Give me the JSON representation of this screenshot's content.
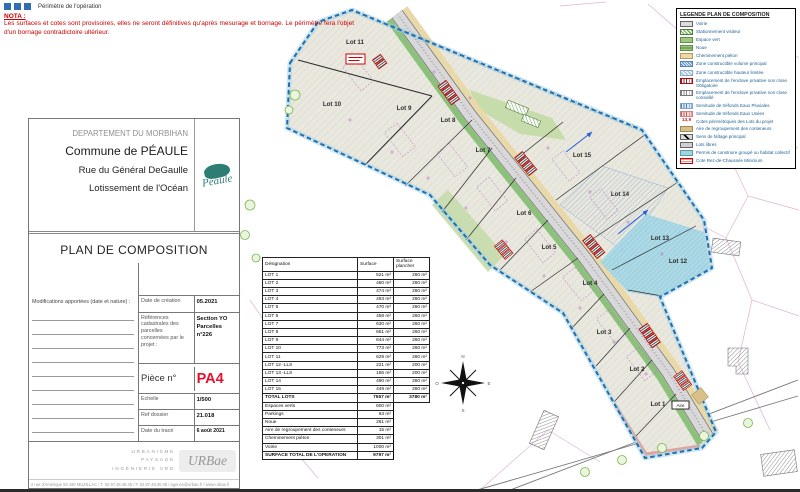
{
  "nota": {
    "perimeter_label": "Périmètre de l'opération",
    "title": "NOTA :",
    "text": "Les surfaces et cotes sont provisoires, elles ne seront définitives qu'après mesurage et bornage. Le périmètre fera l'objet d'un bornage contradictoire ultérieur."
  },
  "title_block": {
    "department": "DEPARTEMENT DU MORBIHAN",
    "commune": "Commune de PÉAULE",
    "street": "Rue du Général DeGaulle",
    "project": "Lotissement de l'Océan",
    "doc_title": "PLAN DE COMPOSITION",
    "logo_text": "Péaule",
    "modifications_label": "Modifications apportées (date et nature) :",
    "date_creation_label": "Date de création",
    "date_creation_value": "05.2021",
    "cadastral_label": "Références cadastrales des parcelles concernées par le projet :",
    "cadastral_value_1": "Section YO",
    "cadastral_value_2": "Parcelles n°226",
    "piece_label": "Pièce n°",
    "piece_value": "PA4",
    "echelle_label": "Echelle",
    "echelle_value": "1/500",
    "ref_label": "Ref dossier",
    "ref_value": "21.018",
    "trace_label": "Date du tracé",
    "trace_value": "6 août 2021"
  },
  "agency": {
    "lines": [
      "URBANISME",
      "PAYSAGE",
      "INGÉNIERIE VRD"
    ],
    "logo": "URBae",
    "address": "2 rue d'Amérique 56 190 MUZILLAC / T. 02.97.45.49.49 / F. 02.97.48.30.35 / agence@urbae.fr / www.urbae.fr"
  },
  "table": {
    "headers": [
      "Désignation",
      "Surface",
      "Surface plancher"
    ],
    "lot_rows": [
      {
        "name": "LOT 1",
        "surface": "521 m²",
        "plancher": "260 m²"
      },
      {
        "name": "LOT 2",
        "surface": "460 m²",
        "plancher": "260 m²"
      },
      {
        "name": "LOT 3",
        "surface": "474 m²",
        "plancher": "260 m²"
      },
      {
        "name": "LOT 4",
        "surface": "493 m²",
        "plancher": "260 m²"
      },
      {
        "name": "LOT 5",
        "surface": "470 m²",
        "plancher": "260 m²"
      },
      {
        "name": "LOT 6",
        "surface": "458 m²",
        "plancher": "260 m²"
      },
      {
        "name": "LOT 7",
        "surface": "630 m²",
        "plancher": "260 m²"
      },
      {
        "name": "LOT 8",
        "surface": "661 m²",
        "plancher": "260 m²"
      },
      {
        "name": "LOT 9",
        "surface": "644 m²",
        "plancher": "260 m²"
      },
      {
        "name": "LOT 10",
        "surface": "773 m²",
        "plancher": "260 m²"
      },
      {
        "name": "LOT 11",
        "surface": "629 m²",
        "plancher": "260 m²"
      },
      {
        "name": "LOT 12 -LLS",
        "surface": "221 m²",
        "plancher": "200 m²"
      },
      {
        "name": "LOT 13 -LLS",
        "surface": "186 m²",
        "plancher": "200 m²"
      },
      {
        "name": "LOT 14",
        "surface": "490 m²",
        "plancher": "260 m²"
      },
      {
        "name": "LOT 15",
        "surface": "449 m²",
        "plancher": "260 m²"
      }
    ],
    "total_row": {
      "name": "TOTAL LOTS",
      "surface": "7557 m²",
      "plancher": "3780 m²"
    },
    "extra_rows": [
      {
        "name": "Espaces verts",
        "surface": "600 m²"
      },
      {
        "name": "Parkings",
        "surface": "63 m²"
      },
      {
        "name": "Noue",
        "surface": "261 m²"
      },
      {
        "name": "Aire de regroupement des conteneurs",
        "surface": "15 m²"
      },
      {
        "name": "Cheminement piéton",
        "surface": "301 m²"
      },
      {
        "name": "Voirie",
        "surface": "1000 m²"
      }
    ],
    "grand_total": {
      "name": "SURFACE TOTAL DE L'OPERATION",
      "surface": "9797 m²"
    }
  },
  "legend": {
    "title": "LEGENDE PLAN DE COMPOSITION",
    "items": [
      {
        "label": "Voirie",
        "swatch": "voirie"
      },
      {
        "label": "Stationnement visiteur",
        "swatch": "parking"
      },
      {
        "label": "Espace vert",
        "swatch": "vert"
      },
      {
        "label": "Noue",
        "swatch": "noue"
      },
      {
        "label": "Cheminement piéton",
        "swatch": "chem"
      },
      {
        "label": "Zone constructible volume principal",
        "swatch": "zvp"
      },
      {
        "label": "Zone constructible hauteur limitée",
        "swatch": "zhl"
      },
      {
        "label": "Emplacement de l'enclave privative non close Obligatoire",
        "swatch": "encl-o"
      },
      {
        "label": "Emplacement de l'enclave privative non close conseillé",
        "swatch": "encl-c"
      },
      {
        "label": "Servitude de tréfonds Eaux Pluviales",
        "swatch": "sep"
      },
      {
        "label": "Servitude de tréfonds Eaux Usées",
        "swatch": "seu"
      },
      {
        "label": "Cotes périmétriques des Lots du projet",
        "swatch": "cotes",
        "symbol_text": "13,9"
      },
      {
        "label": "Aire de regroupement des conteneurs",
        "swatch": "aire"
      },
      {
        "label": "Sens de faîtage principal",
        "swatch": "faitage"
      },
      {
        "label": "Lots libres",
        "swatch": "libres"
      },
      {
        "label": "Permis de construire groupé ou habitat collectif",
        "swatch": "pcg"
      },
      {
        "label": "Cote Rez-de-Chaussée Minimum",
        "swatch": "rdc"
      }
    ]
  },
  "plan": {
    "lots": [
      {
        "label": "Lot 11",
        "x": 355,
        "y": 44
      },
      {
        "label": "Lot 10",
        "x": 332,
        "y": 106
      },
      {
        "label": "Lot 9",
        "x": 404,
        "y": 110
      },
      {
        "label": "Lot 8",
        "x": 448,
        "y": 122
      },
      {
        "label": "Lot 7",
        "x": 483,
        "y": 152
      },
      {
        "label": "Lot 15",
        "x": 582,
        "y": 157
      },
      {
        "label": "Lot 6",
        "x": 524,
        "y": 215
      },
      {
        "label": "Lot 14",
        "x": 620,
        "y": 196
      },
      {
        "label": "Lot 5",
        "x": 549,
        "y": 249
      },
      {
        "label": "Lot 13",
        "x": 660,
        "y": 240
      },
      {
        "label": "Lot 12",
        "x": 678,
        "y": 263
      },
      {
        "label": "Lot 4",
        "x": 590,
        "y": 285
      },
      {
        "label": "Lot 3",
        "x": 604,
        "y": 334
      },
      {
        "label": "Lot 2",
        "x": 637,
        "y": 371
      },
      {
        "label": "Lot 1",
        "x": 658,
        "y": 406
      }
    ],
    "aire_label": "Aire",
    "compass_letters": {
      "n": "N",
      "s": "S",
      "e": "E",
      "o": "O"
    }
  },
  "colors": {
    "nota_red": "#cc0000",
    "piece_red": "#e8112d",
    "legend_text": "#1d5f94",
    "perimeter_blue": "#1d6fae",
    "peaule_teal": "#2e7d74"
  }
}
